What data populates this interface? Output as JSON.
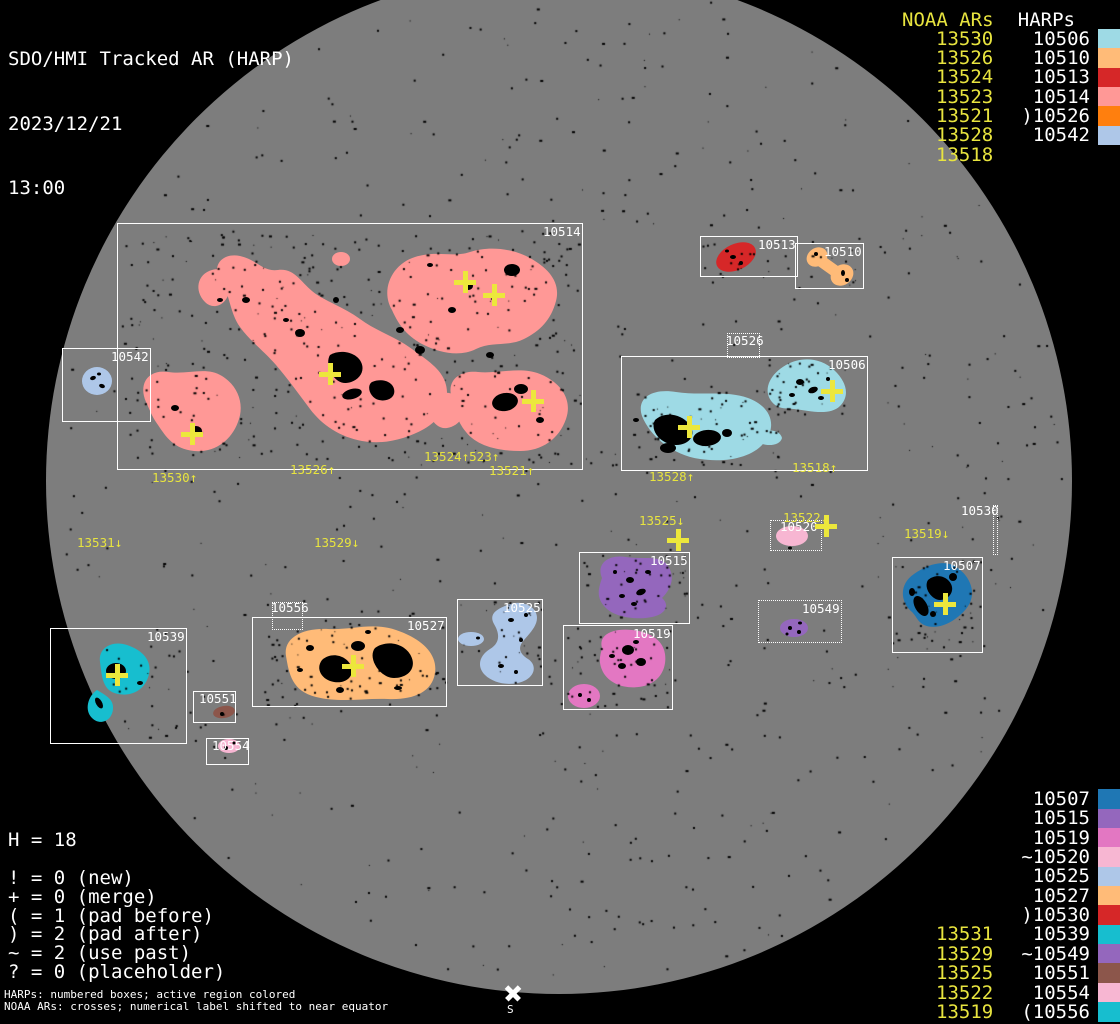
{
  "title": {
    "line1": "SDO/HMI Tracked AR (HARP)",
    "line2": "2023/12/21",
    "line3": "13:00"
  },
  "colors": {
    "background": "#000000",
    "disk": "#7d7d7d",
    "box_border": "#ffffff",
    "label_white": "#ffffff",
    "noaa_yellow": "#e8e43f",
    "cross_yellow": "#ece73c",
    "speck_black": "#000000"
  },
  "harp_colors": {
    "10506": "#9edae5",
    "10510": "#ffbb78",
    "10513": "#d62728",
    "10514": "#ff9896",
    "10526": "#ff7f0e",
    "10542": "#aec7e8",
    "10507": "#1f77b4",
    "10515": "#9467bd",
    "10519": "#e377c2",
    "10520": "#f7b6d2",
    "10525": "#aec7e8",
    "10527": "#ffbb78",
    "10530": "#d62728",
    "10539": "#17becf",
    "10549": "#9467bd",
    "10551": "#8c564b",
    "10554": "#f7b6d2",
    "10556": "#17becf"
  },
  "legend_top": {
    "noaa_header": "NOAA ARs",
    "harp_header": "HARPs",
    "rows": [
      {
        "noaa": "13530",
        "prefix": "",
        "harp": "10506"
      },
      {
        "noaa": "13526",
        "prefix": "",
        "harp": "10510"
      },
      {
        "noaa": "13524",
        "prefix": "",
        "harp": "10513"
      },
      {
        "noaa": "13523",
        "prefix": "",
        "harp": "10514"
      },
      {
        "noaa": "13521",
        "prefix": ")",
        "harp": "10526"
      },
      {
        "noaa": "13528",
        "prefix": "",
        "harp": "10542"
      },
      {
        "noaa": "13518",
        "prefix": "",
        "harp": ""
      }
    ]
  },
  "legend_bottom": {
    "rows": [
      {
        "noaa": "",
        "prefix": "",
        "harp": "10507"
      },
      {
        "noaa": "",
        "prefix": "",
        "harp": "10515"
      },
      {
        "noaa": "",
        "prefix": "",
        "harp": "10519"
      },
      {
        "noaa": "",
        "prefix": "~",
        "harp": "10520"
      },
      {
        "noaa": "",
        "prefix": "",
        "harp": "10525"
      },
      {
        "noaa": "",
        "prefix": "",
        "harp": "10527"
      },
      {
        "noaa": "",
        "prefix": ")",
        "harp": "10530"
      },
      {
        "noaa": "13531",
        "prefix": "",
        "harp": "10539"
      },
      {
        "noaa": "13529",
        "prefix": "~",
        "harp": "10549"
      },
      {
        "noaa": "13525",
        "prefix": "",
        "harp": "10551"
      },
      {
        "noaa": "13522",
        "prefix": "",
        "harp": "10554"
      },
      {
        "noaa": "13519",
        "prefix": "(",
        "harp": "10556"
      }
    ]
  },
  "stats": {
    "h_line": "H = 18",
    "flags": [
      "! = 0 (new)",
      "+ = 0 (merge)",
      "( = 1 (pad before)",
      ") = 2 (pad after)",
      "~ = 2 (use past)",
      "? = 0 (placeholder)"
    ]
  },
  "footer": {
    "line1": "HARPs: numbered boxes; active region colored",
    "line2": "NOAA ARs: crosses; numerical label shifted to near equator"
  },
  "south": {
    "label": "S"
  },
  "boxes": [
    {
      "harp": "10514",
      "x": 117,
      "y": 223,
      "w": 466,
      "h": 247,
      "dotted": false
    },
    {
      "harp": "10542",
      "x": 62,
      "y": 348,
      "w": 89,
      "h": 74,
      "dotted": false
    },
    {
      "harp": "10513",
      "x": 700,
      "y": 236,
      "w": 98,
      "h": 41,
      "dotted": false
    },
    {
      "harp": "10510",
      "x": 795,
      "y": 243,
      "w": 69,
      "h": 46,
      "dotted": false
    },
    {
      "harp": "10526",
      "x": 727,
      "y": 333,
      "w": 33,
      "h": 25,
      "dotted": true,
      "lx": 726,
      "ly": 334
    },
    {
      "harp": "10506",
      "x": 621,
      "y": 356,
      "w": 247,
      "h": 115,
      "dotted": false
    },
    {
      "harp": "10515",
      "x": 579,
      "y": 552,
      "w": 111,
      "h": 72,
      "dotted": false
    },
    {
      "harp": "10519",
      "x": 563,
      "y": 625,
      "w": 110,
      "h": 85,
      "dotted": false
    },
    {
      "harp": "10520",
      "x": 770,
      "y": 520,
      "w": 52,
      "h": 31,
      "dotted": true,
      "lx": 780,
      "ly": 520
    },
    {
      "harp": "10549",
      "x": 758,
      "y": 600,
      "w": 84,
      "h": 43,
      "dotted": true
    },
    {
      "harp": "10507",
      "x": 892,
      "y": 557,
      "w": 91,
      "h": 96,
      "dotted": false
    },
    {
      "harp": "10530",
      "x": 993,
      "y": 505,
      "w": 5,
      "h": 50,
      "dotted": true,
      "lx": 961,
      "ly": 504
    },
    {
      "harp": "10539",
      "x": 50,
      "y": 628,
      "w": 137,
      "h": 116,
      "dotted": false
    },
    {
      "harp": "10551",
      "x": 193,
      "y": 691,
      "w": 43,
      "h": 32,
      "dotted": false,
      "lx": 199,
      "ly": 692
    },
    {
      "harp": "10554",
      "x": 206,
      "y": 738,
      "w": 43,
      "h": 27,
      "dotted": false,
      "lx": 212,
      "ly": 739
    },
    {
      "harp": "10556",
      "x": 272,
      "y": 602,
      "w": 31,
      "h": 28,
      "dotted": true,
      "lx": 271,
      "ly": 601
    },
    {
      "harp": "10527",
      "x": 252,
      "y": 617,
      "w": 195,
      "h": 90,
      "dotted": false
    },
    {
      "harp": "10525",
      "x": 457,
      "y": 599,
      "w": 86,
      "h": 87,
      "dotted": false
    }
  ],
  "disk_labels": [
    {
      "text": "13530↑",
      "x": 152,
      "y": 471
    },
    {
      "text": "13526↑",
      "x": 290,
      "y": 463
    },
    {
      "text": "13524↑523↑",
      "x": 424,
      "y": 450
    },
    {
      "text": "13521↑",
      "x": 489,
      "y": 464
    },
    {
      "text": "13528↑",
      "x": 649,
      "y": 470
    },
    {
      "text": "13518↑",
      "x": 792,
      "y": 461
    },
    {
      "text": "13531↓",
      "x": 77,
      "y": 536
    },
    {
      "text": "13529↓",
      "x": 314,
      "y": 536
    },
    {
      "text": "13525↓",
      "x": 639,
      "y": 514
    },
    {
      "text": "13522↓",
      "x": 783,
      "y": 511
    },
    {
      "text": "13519↓",
      "x": 904,
      "y": 527
    }
  ],
  "crosses": [
    {
      "x": 465,
      "y": 282
    },
    {
      "x": 494,
      "y": 295
    },
    {
      "x": 330,
      "y": 374
    },
    {
      "x": 533,
      "y": 401
    },
    {
      "x": 192,
      "y": 434
    },
    {
      "x": 832,
      "y": 391
    },
    {
      "x": 689,
      "y": 427
    },
    {
      "x": 678,
      "y": 540
    },
    {
      "x": 826,
      "y": 526
    },
    {
      "x": 353,
      "y": 666
    },
    {
      "x": 117,
      "y": 675
    },
    {
      "x": 945,
      "y": 604
    }
  ],
  "chart_data": {
    "type": "scatter",
    "title": "SDO/HMI Tracked AR (HARP) — 2023/12/21 13:00",
    "harp_total": 18,
    "flag_counts": {
      "new": 0,
      "merge": 0,
      "pad_before": 1,
      "pad_after": 2,
      "use_past": 2,
      "placeholder": 0
    },
    "noaa_to_harp": [
      {
        "noaa": "13530",
        "harp": "10506"
      },
      {
        "noaa": "13526",
        "harp": "10510"
      },
      {
        "noaa": "13524",
        "harp": "10513"
      },
      {
        "noaa": "13523",
        "harp": "10514"
      },
      {
        "noaa": "13521",
        "harp": "10526"
      },
      {
        "noaa": "13528",
        "harp": "10542"
      },
      {
        "noaa": "13531",
        "harp": "10539"
      },
      {
        "noaa": "13529",
        "harp": "10549"
      },
      {
        "noaa": "13525",
        "harp": "10551"
      },
      {
        "noaa": "13522",
        "harp": "10554"
      },
      {
        "noaa": "13519",
        "harp": "10556"
      },
      {
        "noaa": "13518",
        "harp": ""
      }
    ],
    "harp_box_centers": [
      {
        "harp": "10514",
        "x": 350,
        "y": 346
      },
      {
        "harp": "10542",
        "x": 106,
        "y": 385
      },
      {
        "harp": "10513",
        "x": 749,
        "y": 256
      },
      {
        "harp": "10510",
        "x": 829,
        "y": 266
      },
      {
        "harp": "10526",
        "x": 743,
        "y": 345
      },
      {
        "harp": "10506",
        "x": 744,
        "y": 413
      },
      {
        "harp": "10515",
        "x": 634,
        "y": 588
      },
      {
        "harp": "10519",
        "x": 618,
        "y": 667
      },
      {
        "harp": "10520",
        "x": 796,
        "y": 535
      },
      {
        "harp": "10549",
        "x": 800,
        "y": 621
      },
      {
        "harp": "10507",
        "x": 937,
        "y": 605
      },
      {
        "harp": "10530",
        "x": 995,
        "y": 530
      },
      {
        "harp": "10539",
        "x": 118,
        "y": 686
      },
      {
        "harp": "10551",
        "x": 214,
        "y": 707
      },
      {
        "harp": "10554",
        "x": 227,
        "y": 751
      },
      {
        "harp": "10556",
        "x": 287,
        "y": 616
      },
      {
        "harp": "10527",
        "x": 349,
        "y": 662
      },
      {
        "harp": "10525",
        "x": 500,
        "y": 642
      }
    ]
  }
}
